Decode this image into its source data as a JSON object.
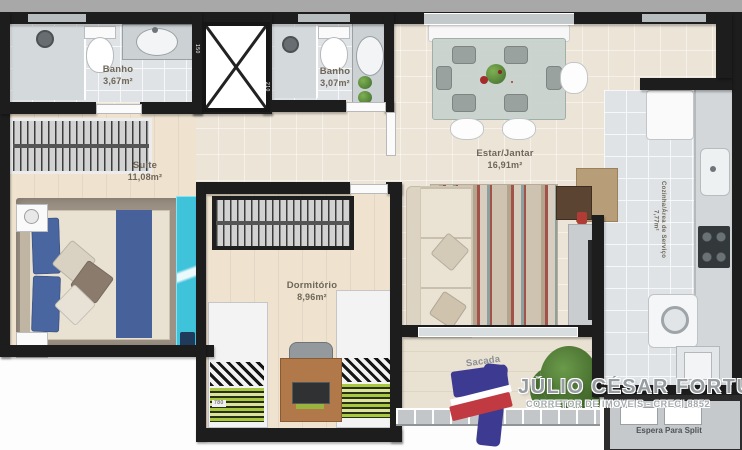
{
  "plan": {
    "rooms": [
      {
        "id": "banho1",
        "name": "Banho",
        "area": "3,67m²"
      },
      {
        "id": "banho2",
        "name": "Banho",
        "area": "3,07m²"
      },
      {
        "id": "suite",
        "name": "Suite",
        "area": "11,08m²"
      },
      {
        "id": "estar",
        "name": "Estar/Jantar",
        "area": "16,91m²"
      },
      {
        "id": "dormitorio",
        "name": "Dormitório",
        "area": "8,96m²"
      },
      {
        "id": "cozinha",
        "name": "Cozinha/Área de Serviço",
        "area": "7,77m²"
      },
      {
        "id": "sacada",
        "name": "Sacada",
        "area": "2,47m²"
      }
    ],
    "notes": {
      "espera_split": "Espera Para Split"
    },
    "wall_dimensions": {
      "a": "150",
      "b": "210",
      "c": "780"
    }
  },
  "watermark": {
    "name": "JÚLIO CÉSAR FORTUNA",
    "subtitle": "CORRETOR DE IMÓVEIS - CRECI 8852"
  },
  "colors": {
    "wall": "#1d1d1d",
    "glass_partition": "#3ec3da",
    "rug_accent_red": "#a3524a",
    "bed_runner_blue": "#47629b",
    "logo_blue": "#3d3a92",
    "logo_red": "#c13a42"
  }
}
